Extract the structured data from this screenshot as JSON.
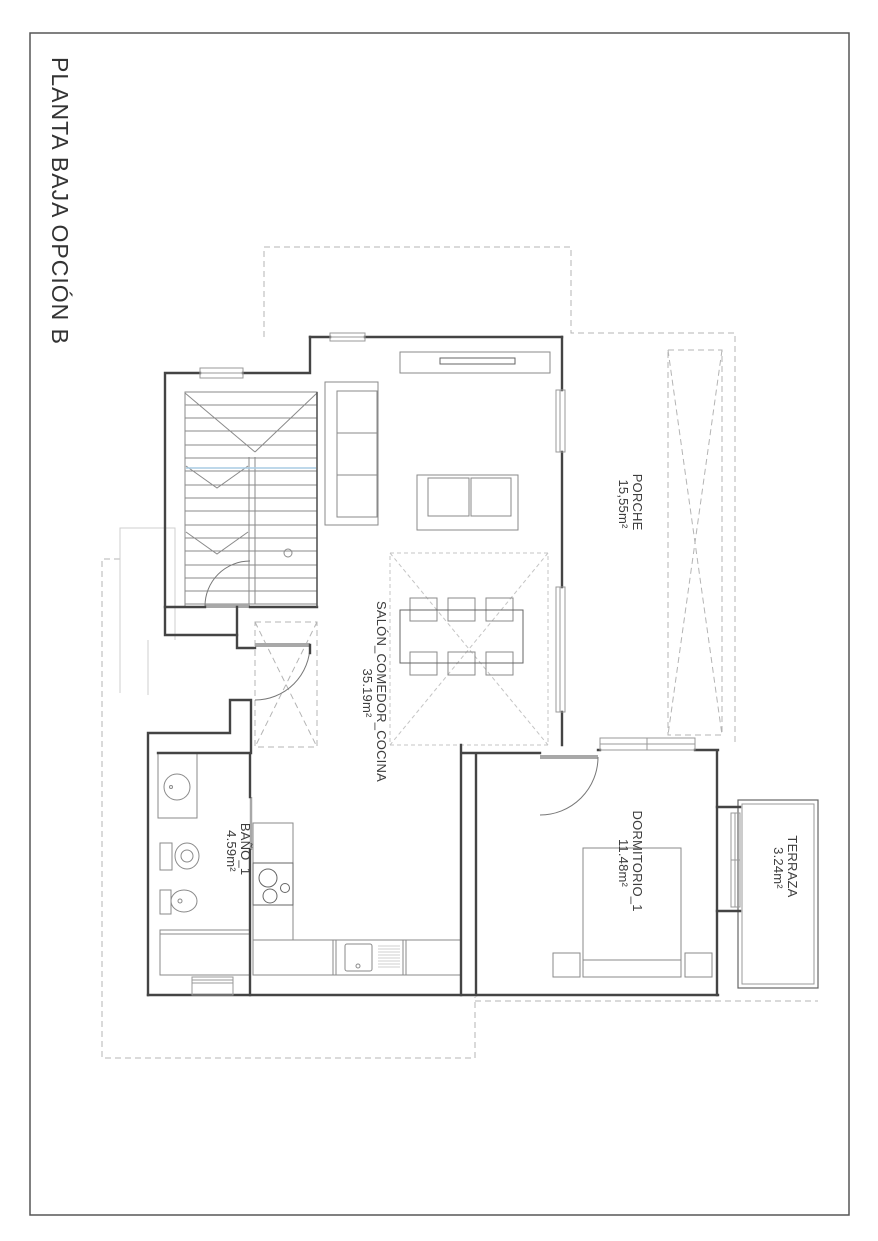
{
  "page": {
    "title": "PLANTA BAJA OPCIÓN B"
  },
  "rooms": [
    {
      "name": "PORCHE",
      "area": "15,55m²"
    },
    {
      "name": "SALÓN_COMEDOR_COCINA",
      "area": "35.19m²"
    },
    {
      "name": "DORMITORIO_1",
      "area": "11.48m²"
    },
    {
      "name": "BAÑO_1",
      "area": "4.59m²"
    },
    {
      "name": "TERRAZA",
      "area": "3.24m²"
    }
  ],
  "colors": {
    "wall": "#444444",
    "furniture": "#8a8a8a",
    "dashed_outline": "#b4b4b4",
    "stair_section_line": "#a9cce3",
    "frame": "#565656"
  }
}
